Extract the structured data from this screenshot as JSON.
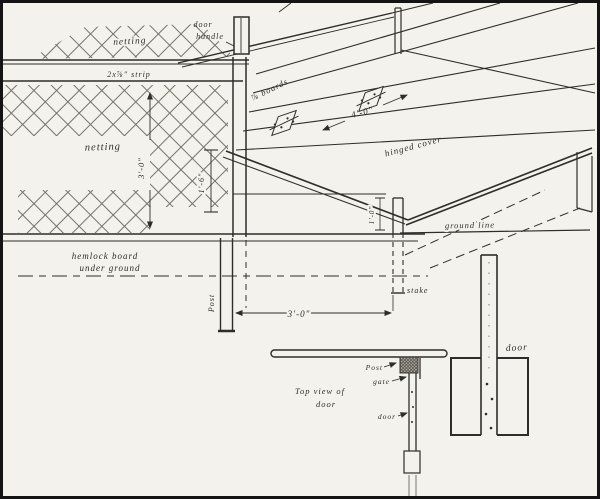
{
  "colors": {
    "ink": "#2f2d29",
    "paper": "#f4f2ec",
    "net": "#75716a",
    "border": "#141414"
  },
  "labels": {
    "netting_top": "netting",
    "netting_left": "netting",
    "door_handle_1": "door",
    "door_handle_2": "handle",
    "strip": "2x⅞\" strip",
    "boards": "⅞ boards",
    "cover_width": "4'-0\"",
    "hinged_cover": "hinged cover",
    "netting_height": "3'-0\"",
    "board_height": "1'-6\"",
    "ground_line": "ground line",
    "hemlock_1": "hemlock board",
    "hemlock_2": "under ground",
    "post": "Post",
    "post_spacing": "3'-0\"",
    "stake": "stake",
    "stake_depth": "1'-0\"",
    "top_view_1": "Top view of",
    "top_view_2": "door",
    "tv_post": "Post",
    "tv_gate": "gate",
    "tv_door": "door",
    "detail_door": "door"
  }
}
